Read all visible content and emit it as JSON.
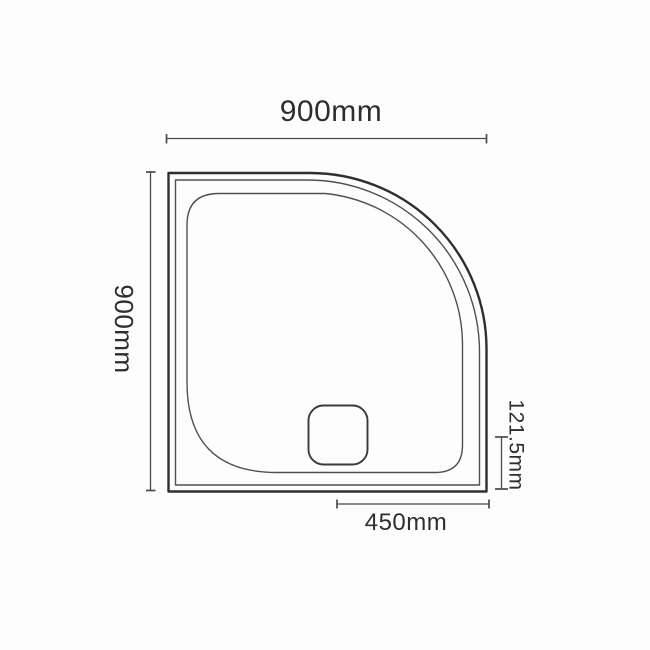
{
  "diagram": {
    "type": "technical-dimension-drawing",
    "subject": "quadrant-shower-tray-plan-view",
    "dimensions": {
      "width": {
        "label": "900mm",
        "value_mm": 900,
        "orientation": "horizontal",
        "position": "top"
      },
      "depth": {
        "label": "900mm",
        "value_mm": 900,
        "orientation": "vertical",
        "position": "left"
      },
      "tray_height": {
        "label": "121.5mm",
        "value_mm": 121.5,
        "orientation": "vertical",
        "position": "right"
      },
      "waste_centre": {
        "label": "450mm",
        "value_mm": 450,
        "orientation": "horizontal",
        "position": "bottom"
      }
    },
    "colors": {
      "outline": "#2f2f2f",
      "thin_line": "#4f4f4f",
      "dimension_line": "#4a4a4a",
      "text": "#2e2e2e",
      "background": "#fdfdfd"
    }
  }
}
